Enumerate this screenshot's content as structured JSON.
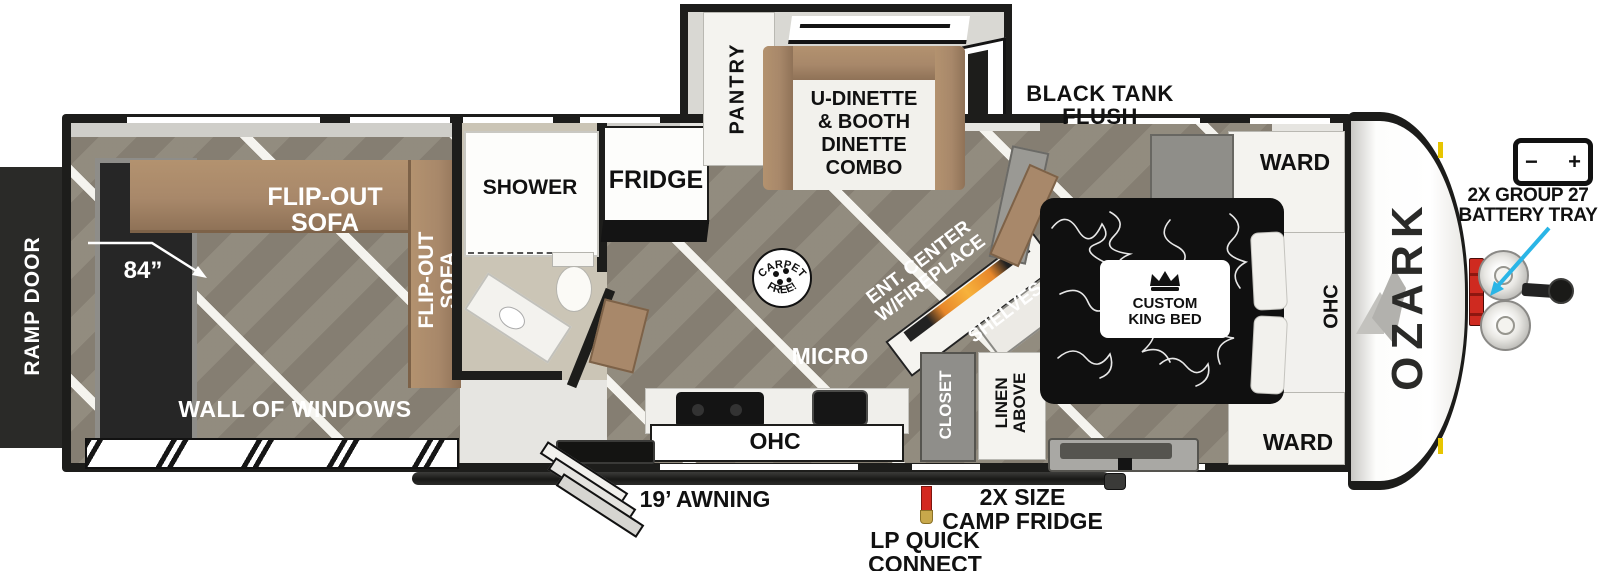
{
  "plan": {
    "rear": {
      "ramp_door": "RAMP DOOR",
      "sofa_top_l1": "FLIP-OUT",
      "sofa_top_l2": "SOFA",
      "sofa_side_l1": "FLIP-OUT",
      "sofa_side_l2": "SOFA",
      "sofa_dim": "84”",
      "wall_of_windows": "WALL OF WINDOWS"
    },
    "bath": {
      "shower": "SHOWER"
    },
    "kitchen": {
      "fridge": "FRIDGE",
      "pantry": "PANTRY",
      "micro": "MICRO",
      "ohc": "OHC"
    },
    "dinette": {
      "l1": "U-DINETTE",
      "l2": "& BOOTH",
      "l3": "DINETTE",
      "l4": "COMBO"
    },
    "living": {
      "ent_l1": "ENT. CENTER",
      "ent_l2": "W/FIREPLACE",
      "shelves": "SHELVES",
      "closet": "CLOSET",
      "linen_l1": "LINEN",
      "linen_l2": "ABOVE"
    },
    "bedroom": {
      "bed_l1": "CUSTOM",
      "bed_l2": "KING BED",
      "ward_top": "WARD",
      "ward_bottom": "WARD",
      "ohc": "OHC"
    },
    "badge": {
      "top": "CARPET",
      "bottom": "FREE!"
    },
    "brand": "OZARK",
    "battery_icon": {
      "minus": "−",
      "plus": "+"
    },
    "callouts": {
      "black_tank_l1": "BLACK TANK",
      "black_tank_l2": "FLUSH",
      "battery_l1": "2X GROUP 27",
      "battery_l2": "BATTERY TRAY",
      "awning": "19’ AWNING",
      "lp_l1": "LP QUICK",
      "lp_l2": "CONNECT",
      "camp_l1": "2X SIZE",
      "camp_l2": "CAMP FRIDGE"
    }
  },
  "colors": {
    "wall": "#1d1d1b",
    "floor": "#8d8679",
    "wood": "#a8886a",
    "bath_floor": "#cbc5b6",
    "accent_arrow": "#2ab5e6",
    "lp_red": "#d3281f",
    "bed": "#101010"
  }
}
